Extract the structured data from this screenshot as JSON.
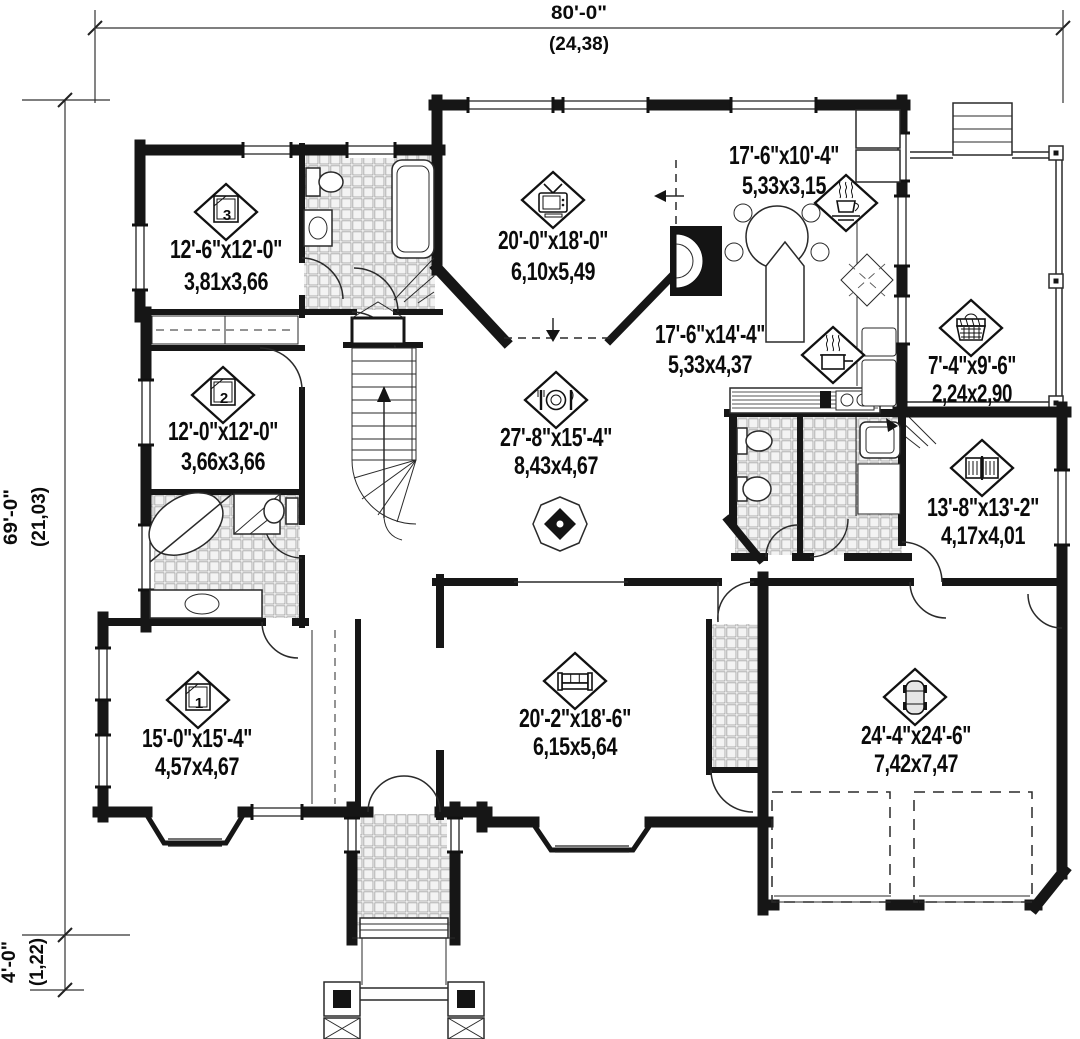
{
  "title": "Single storey house floor plan",
  "overall_dimensions": {
    "width": {
      "imperial": "80'-0\"",
      "metric": "(24,38)"
    },
    "height": {
      "imperial": "69'-0\"",
      "metric": "(21,03)"
    },
    "front_porch_depth": {
      "imperial": "4'-0\"",
      "metric": "(1,22)"
    }
  },
  "rooms": [
    {
      "id": "bedroom-3",
      "icon": "bed-icon",
      "number": "3",
      "imperial": "12'-6\"x12'-0\"",
      "metric": "3,81x3,66"
    },
    {
      "id": "bedroom-2",
      "icon": "bed-icon",
      "number": "2",
      "imperial": "12'-0\"x12'-0\"",
      "metric": "3,66x3,66"
    },
    {
      "id": "family-room",
      "icon": "tv-icon",
      "number": "",
      "imperial": "20'-0\"x18'-0\"",
      "metric": "6,10x5,49"
    },
    {
      "id": "breakfast-area",
      "icon": "coffee-cup-icon",
      "number": "",
      "imperial": "17'-6\"x10'-4\"",
      "metric": "5,33x3,15"
    },
    {
      "id": "kitchen",
      "icon": "cooking-pot-icon",
      "number": "",
      "imperial": "17'-6\"x14'-4\"",
      "metric": "5,33x4,37"
    },
    {
      "id": "laundry-porch",
      "icon": "laundry-basket-icon",
      "number": "",
      "imperial": "7'-4\"x9'-6\"",
      "metric": "2,24x2,90"
    },
    {
      "id": "study",
      "icon": "open-book-icon",
      "number": "",
      "imperial": "13'-8\"x13'-2\"",
      "metric": "4,17x4,01"
    },
    {
      "id": "dining-room",
      "icon": "plate-cutlery-icon",
      "number": "",
      "imperial": "27'-8\"x15'-4\"",
      "metric": "8,43x4,67"
    },
    {
      "id": "living-room",
      "icon": "sofa-icon",
      "number": "",
      "imperial": "20'-2\"x18'-6\"",
      "metric": "6,15x5,64"
    },
    {
      "id": "master-bedroom",
      "icon": "bed-icon",
      "number": "1",
      "imperial": "15'-0\"x15'-4\"",
      "metric": "4,57x4,67"
    },
    {
      "id": "garage",
      "icon": "car-icon",
      "number": "",
      "imperial": "24'-4\"x24'-6\"",
      "metric": "7,42x7,47"
    }
  ]
}
